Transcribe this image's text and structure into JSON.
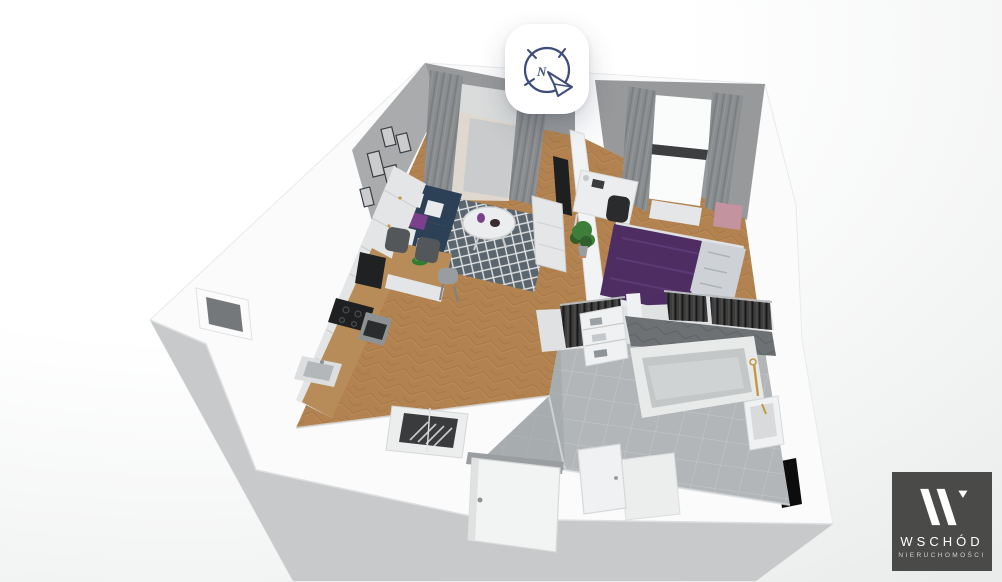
{
  "badge": {
    "icon": "compass-icon",
    "north_label": "N"
  },
  "logo": {
    "mark": "W",
    "name": "WSCHÓD",
    "subtitle": "NIERUCHOMOŚCI"
  },
  "colors": {
    "bg1": "#ffffff",
    "bg2": "#eaecec",
    "wallTop": "#fbfbfc",
    "wallEdge": "#e8eaea",
    "wallFace": "#c7c9cb",
    "wallInner": "#a9abad",
    "backWall": "#97999b",
    "wood": "#b28350",
    "woodDark": "#9d7140",
    "woodLight": "#c6975f",
    "tile": "#b2b6b8",
    "tileLine": "#ccd0d1",
    "tileDark": "#9aa0a2",
    "darkWall": "#6d7174",
    "darkWallLine": "#5d6164",
    "sofa": "#2c4156",
    "sofaDark": "#24364a",
    "rug": "#5b656d",
    "rugLine": "#dfe2e3",
    "bedBlanket": "#4e2d63",
    "bedBlanketLight": "#5d3a74",
    "bedPillow": "#ced2d6",
    "accentPurple": "#7c3f8c",
    "cabinet": "#e3e5e6",
    "cabinetLine": "#c9cccd",
    "counterWood": "#b78c58",
    "appliance": "#202123",
    "steel": "#8f9294",
    "gold": "#c09a45",
    "whiteFurn": "#ededee",
    "plant": "#3f7d3b",
    "plantDark": "#2e5f2d",
    "pink": "#c393a0",
    "beige": "#d8cec2",
    "clothes": "#3c3e40",
    "clothesHint": "#6b5a44",
    "curtain": "#8a8d8f",
    "curtainDark": "#75787a",
    "sheer": "#e9eaea",
    "window": "#fafbfb",
    "glass": "#3e4143",
    "chimneyHole": "#75787a",
    "vent": "#0d0d0d",
    "iconBlue": "#3e4d7a",
    "logoBg": "#4a4a49",
    "logoText": "#ffffff"
  }
}
